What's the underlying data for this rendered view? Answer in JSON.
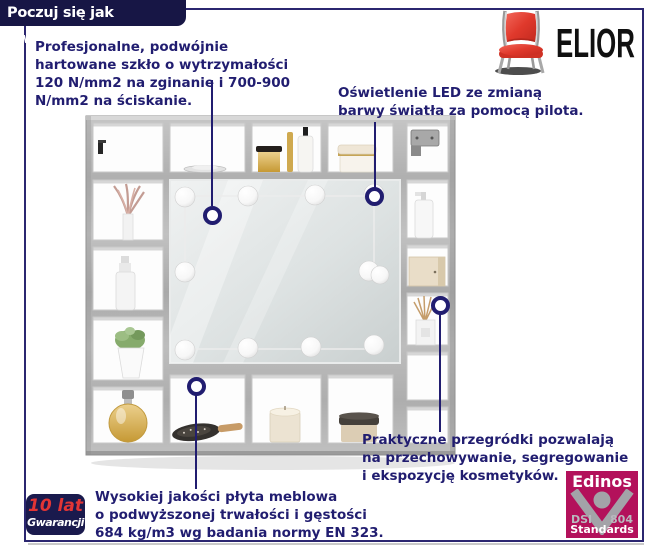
{
  "banner": {
    "title": "Poczuj się jak gwiazda!"
  },
  "logo": {
    "brand": "ELIOR",
    "icon": "red-chair-icon"
  },
  "callouts": {
    "glass": {
      "lines": [
        "Profesjonalne, podwójnie",
        "hartowane szkło o wytrzymałości",
        "120 N/mm2 na zginanie i 700-900",
        "N/mm2 na ściskanie."
      ]
    },
    "led": {
      "lines": [
        "Oświetlenie LED ze zmianą",
        "barwy światła za pomocą pilota."
      ]
    },
    "shelves": {
      "lines": [
        "Praktyczne przegródki pozwalają",
        "na przechowywanie, segregowanie",
        "i ekspozycję kosmetyków."
      ]
    },
    "board": {
      "lines": [
        "Wysokiej jakości płyta meblowa",
        "o podwyższonej trwałości i gęstości",
        "684 kg/m3 wg badania normy EN 323."
      ]
    }
  },
  "badges": {
    "warranty": {
      "value": "10 lat",
      "label": "Gwarancji"
    },
    "edinos": {
      "brand": "Edinos",
      "left": "DSI",
      "right": "804",
      "bottom": "Standards"
    }
  },
  "colors": {
    "text_navy": "#211d70",
    "frame_navy": "#2b2670",
    "banner_bg": "#171645",
    "brand_black": "#101010",
    "warranty_red": "#e23535",
    "warranty_bg": "#1a1a4d",
    "edinos_bg": "#b3115b",
    "edinos_gray": "#a3a3a8",
    "chair_red": "#e8473a",
    "cabinet_gray": "#b5b5b5"
  },
  "product": {
    "type": "mirror-cabinet-with-led-lights",
    "led_bulb_count": 11
  }
}
